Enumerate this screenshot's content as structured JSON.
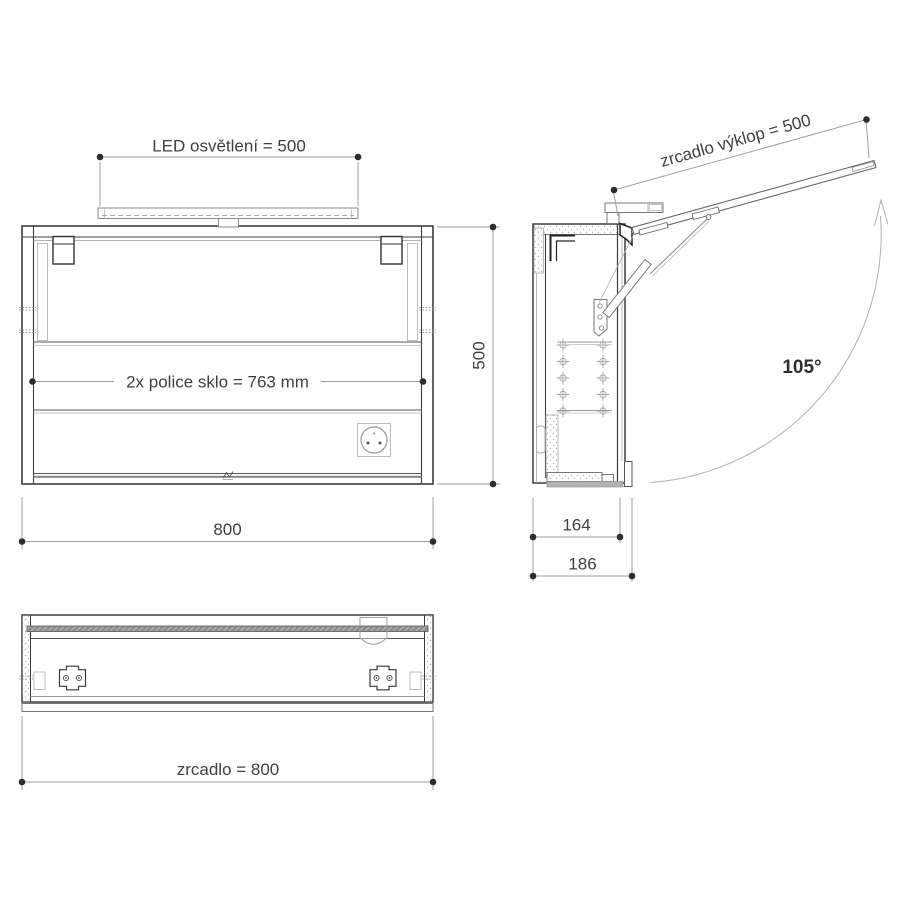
{
  "drawing": {
    "front_view": {
      "led_dimension": "LED osvětlení = 500",
      "shelf_dimension": "2x  police sklo = 763 mm",
      "width_dimension": "800",
      "height_dimension": "500"
    },
    "side_view": {
      "tilt_dimension": "zrcadlo výklop = 500",
      "opening_angle": "105°",
      "inner_depth_dimension": "164",
      "outer_depth_dimension": "186"
    },
    "bottom_view": {
      "mirror_dimension": "zrcadlo = 800"
    },
    "colors": {
      "line": "#3c3c3c",
      "dimension_line": "#9e9e9e",
      "text": "#3f3f3f",
      "background": "#ffffff"
    }
  }
}
